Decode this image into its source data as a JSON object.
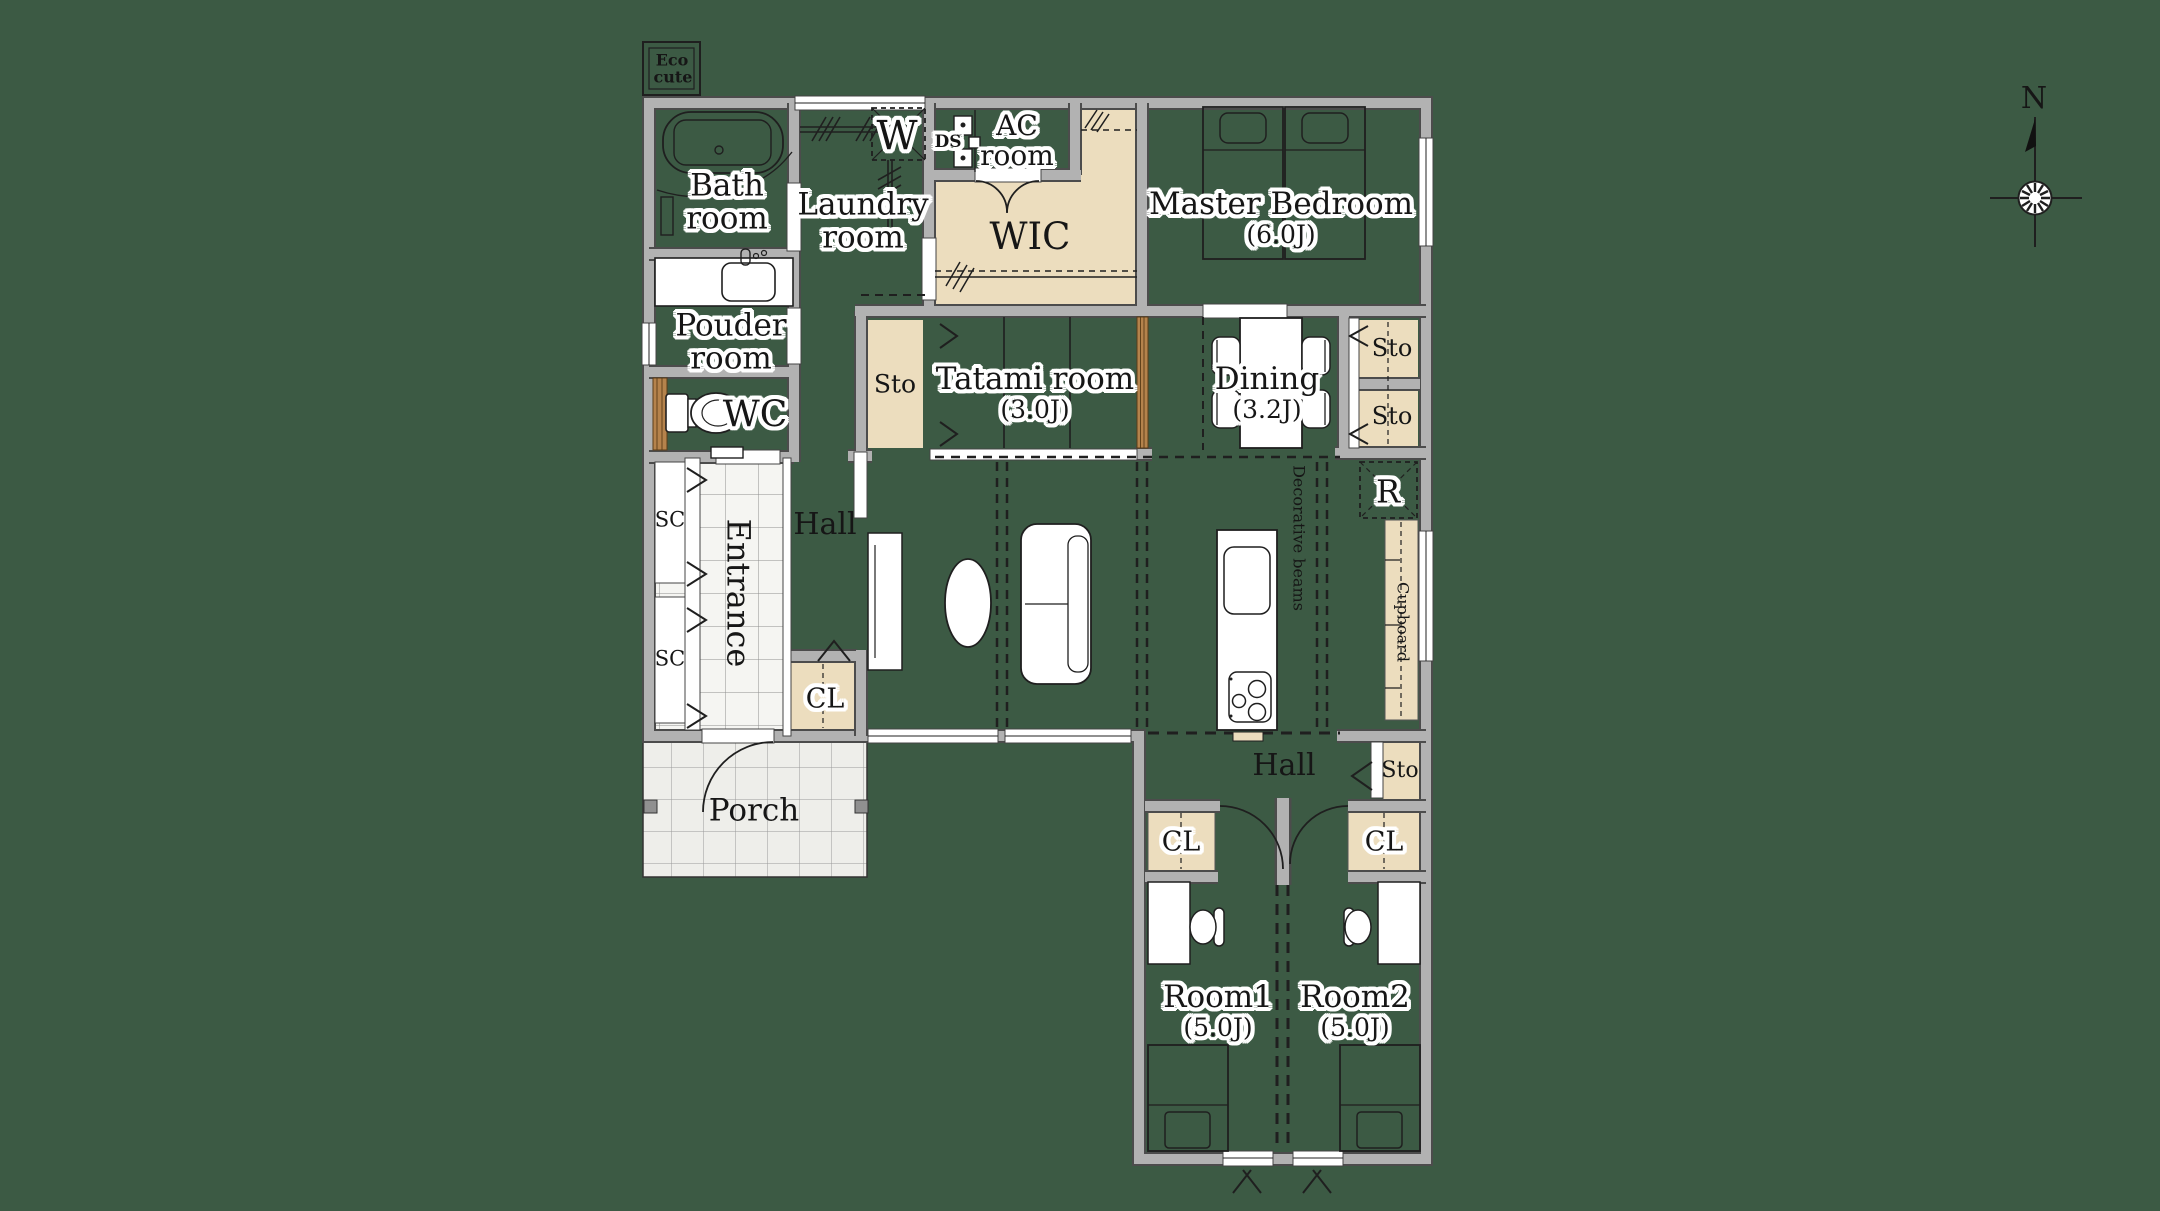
{
  "palette": {
    "background": "#3c5a44",
    "wall_fill": "#b2b2b2",
    "wall_edge": "#4c4c4c",
    "storage_beige": "#ecddbe",
    "wood_door": "#b5834c",
    "fixture_white": "#ffffff",
    "line_black": "#1f1f1f",
    "tile_floor": "#f5f5f2",
    "porch_floor": "#eeeeea"
  },
  "labels": {
    "eco_cute_1": "Eco",
    "eco_cute_2": "cute",
    "bath_1": "Bath",
    "bath_2": "room",
    "laundry_1": "Laundry",
    "laundry_2": "room",
    "washer": "W",
    "ds": "DS",
    "ac_1": "AC",
    "ac_2": "room",
    "wic": "WIC",
    "master": "Master Bedroom",
    "master_size": "(6.0J)",
    "sto_tatami": "Sto",
    "tatami": "Tatami room",
    "tatami_size": "(3.0J)",
    "dining": "Dining",
    "dining_size": "(3.2J)",
    "sto_1": "Sto",
    "sto_2": "Sto",
    "fridge": "R",
    "cupboard": "Cupboard",
    "pouder_1": "Pouder",
    "pouder_2": "room",
    "wc": "WC",
    "sc_1": "SC",
    "sc_2": "SC",
    "entrance": "Entrance",
    "hall_left": "Hall",
    "cl_hall": "CL",
    "porch": "Porch",
    "beams": "Decorative beams",
    "hall_south": "Hall",
    "sto_south": "Sto",
    "cl_room1": "CL",
    "cl_room2": "CL",
    "room1": "Room1",
    "room1_size": "(5.0J)",
    "room2": "Room2",
    "room2_size": "(5.0J)",
    "compass_n": "N"
  }
}
